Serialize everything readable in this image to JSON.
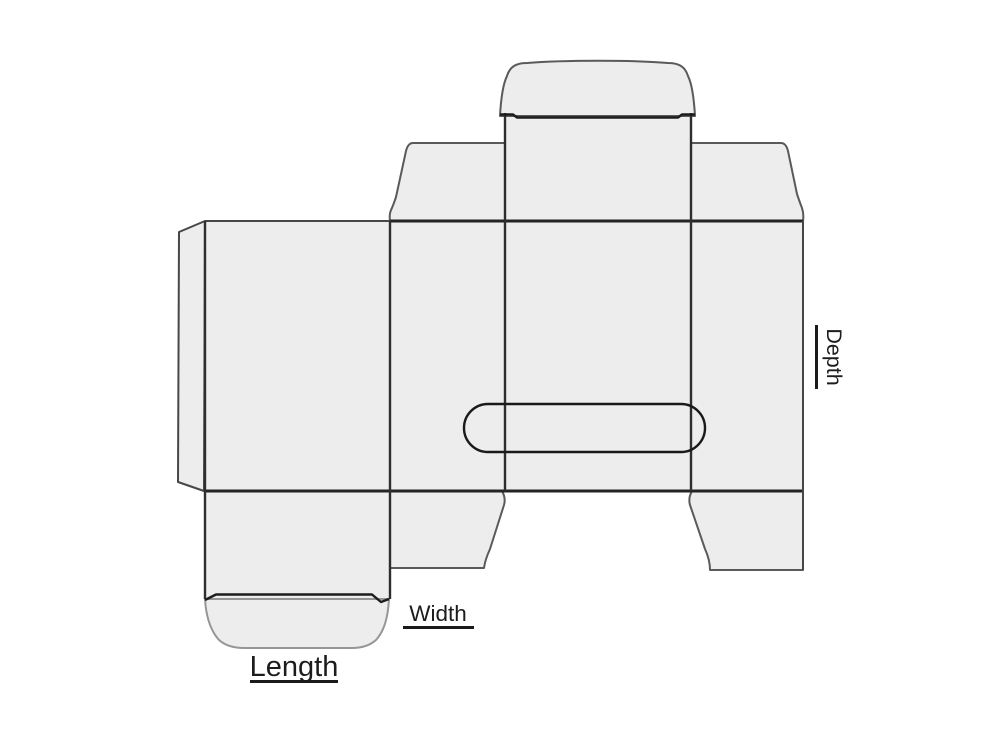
{
  "diagram": {
    "type": "packaging-dieline-reverse-tuck-end-box",
    "labels": {
      "length": "Length",
      "width": "Width",
      "depth": "Depth"
    },
    "colors": {
      "background": "#ffffff",
      "panel_fill": "#ededed",
      "cut_line": "#474747",
      "cut_line_soft": "#5a5a5a",
      "cut_line_light": "#969696",
      "fold_line": "#242424",
      "fold_line_v": "#2e2e2e",
      "crease_line": "#1c1c1c",
      "slot_line": "#1a1a1a",
      "label_text": "#1c1c1c",
      "label_line": "#1a1a1a"
    }
  }
}
